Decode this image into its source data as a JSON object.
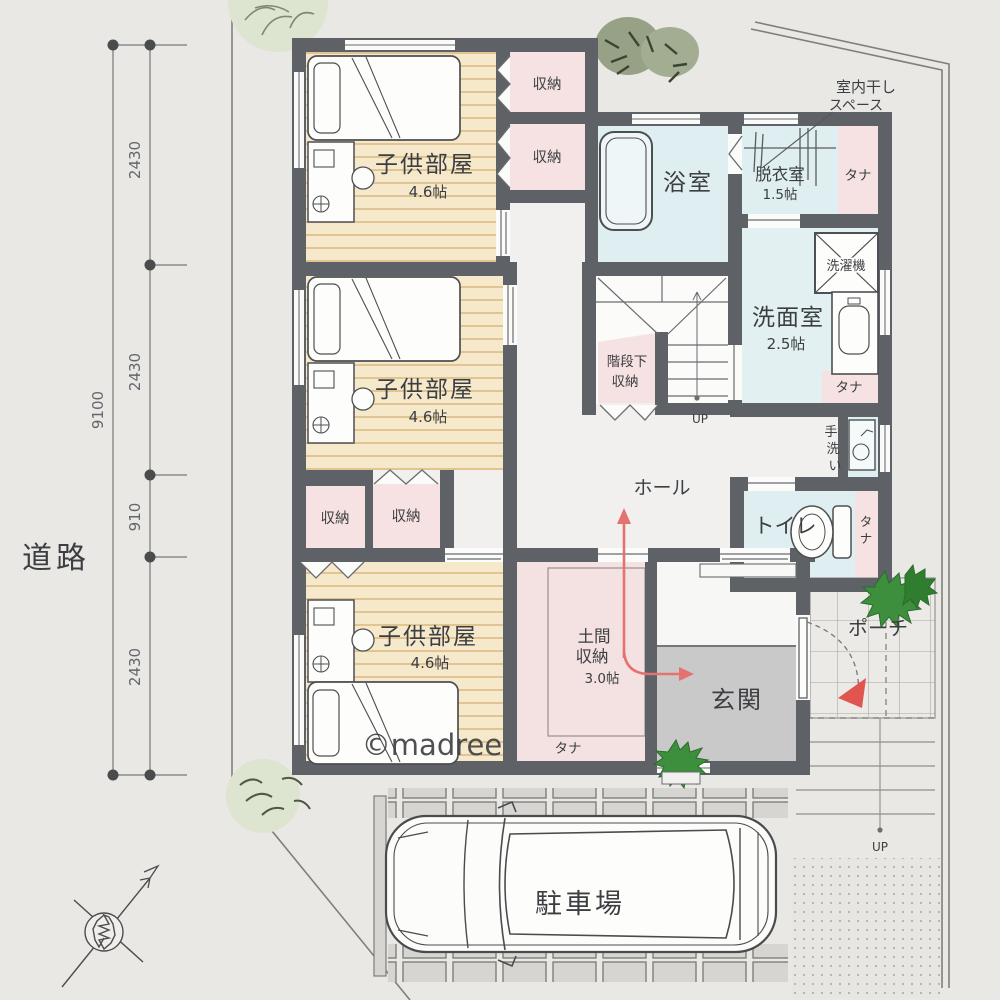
{
  "watermark": "©madree",
  "outside": {
    "road": "道路"
  },
  "dimensions": {
    "segments": [
      "2430",
      "2430",
      "910",
      "2430"
    ],
    "total": "9100"
  },
  "rooms": {
    "kids1": {
      "name": "子供部屋",
      "size": "4.6帖"
    },
    "kids2": {
      "name": "子供部屋",
      "size": "4.6帖"
    },
    "kids3": {
      "name": "子供部屋",
      "size": "4.6帖"
    },
    "bath": {
      "name": "浴室"
    },
    "dressing": {
      "name": "脱衣室",
      "size": "1.5帖"
    },
    "washroom": {
      "name": "洗面室",
      "size": "2.5帖"
    },
    "toilet": {
      "name": "トイレ"
    },
    "hall": {
      "name": "ホール"
    },
    "entrance": {
      "name": "玄関"
    },
    "doma": {
      "name1": "土間",
      "name2": "収納",
      "size": "3.0帖"
    },
    "under_stairs": {
      "name1": "階段下",
      "name2": "収納"
    },
    "porch": {
      "name": "ポーチ"
    },
    "parking": {
      "name": "駐車場"
    }
  },
  "labels": {
    "closet": "収納",
    "shelf": "タナ",
    "washer": "洗濯機",
    "handwash": [
      "手",
      "洗",
      "い"
    ],
    "shelf_vertical": [
      "タ",
      "ナ"
    ],
    "drying1": "室内干し",
    "drying2": "スペース",
    "up": "UP"
  },
  "palette": {
    "wall": "#5e6165",
    "wood_floor": "#f5e8cb",
    "wood_stripe": "#d9b87f",
    "closet_pink": "#f6e2e2",
    "wet_blue": "#dfeef0",
    "entry_gray": "#c9c9ca",
    "arrow_red": "#e4726e",
    "plant_green": "#3e8f3d",
    "paper": "#e9e8e5"
  }
}
